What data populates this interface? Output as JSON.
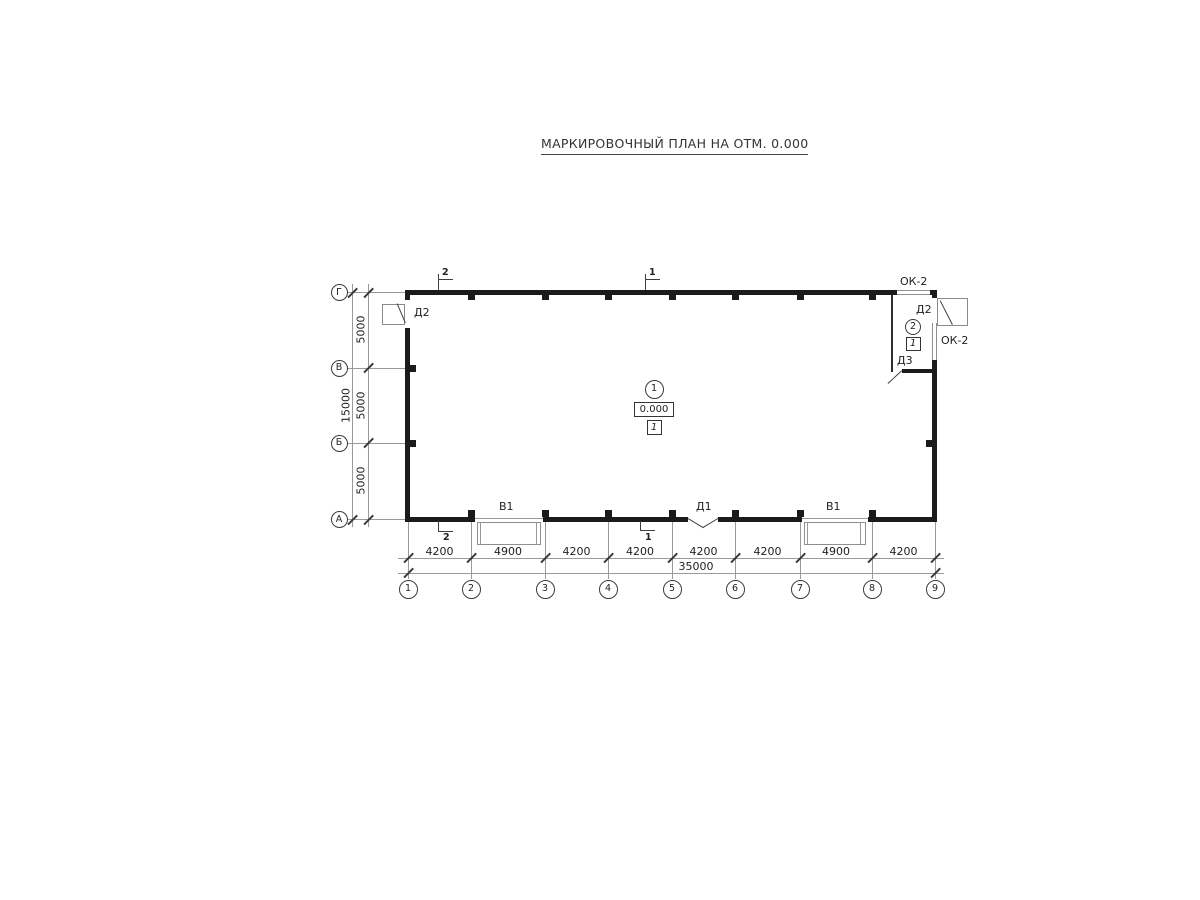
{
  "title": "МАРКИРОВОЧНЫЙ ПЛАН НА ОТМ. 0.000",
  "axes": {
    "columns": [
      "1",
      "2",
      "3",
      "4",
      "5",
      "6",
      "7",
      "8",
      "9"
    ],
    "rows": [
      "Г",
      "В",
      "Б",
      "А"
    ]
  },
  "dims": {
    "bottom_spans": [
      "4200",
      "4900",
      "4200",
      "4200",
      "4200",
      "4200",
      "4900",
      "4200"
    ],
    "bottom_total": "35000",
    "left_spans": [
      "5000",
      "5000",
      "5000"
    ],
    "left_total": "15000"
  },
  "marks": {
    "gate_v1_left": "В1",
    "door_d1": "Д1",
    "gate_v1_right": "В1",
    "door_d2_left": "Д2",
    "door_d2_right": "Д2",
    "door_d3": "Д3",
    "window_ok2_top": "ОК-2",
    "window_ok2_right": "ОК-2"
  },
  "tags": {
    "room1": {
      "number": "1",
      "elevation": "0.000",
      "floor": "1"
    },
    "room2": {
      "number": "2",
      "floor": "1"
    }
  },
  "sections": {
    "top_left": "2",
    "top_right": "1",
    "bottom_left": "2",
    "bottom_center": "1"
  },
  "colors": {
    "wall": "#1b1b1b",
    "thin_line": "#9a9a9a",
    "mark_line": "#3f3f3f",
    "window": "#8f8f8f",
    "text": "#222222",
    "background": "#ffffff"
  }
}
